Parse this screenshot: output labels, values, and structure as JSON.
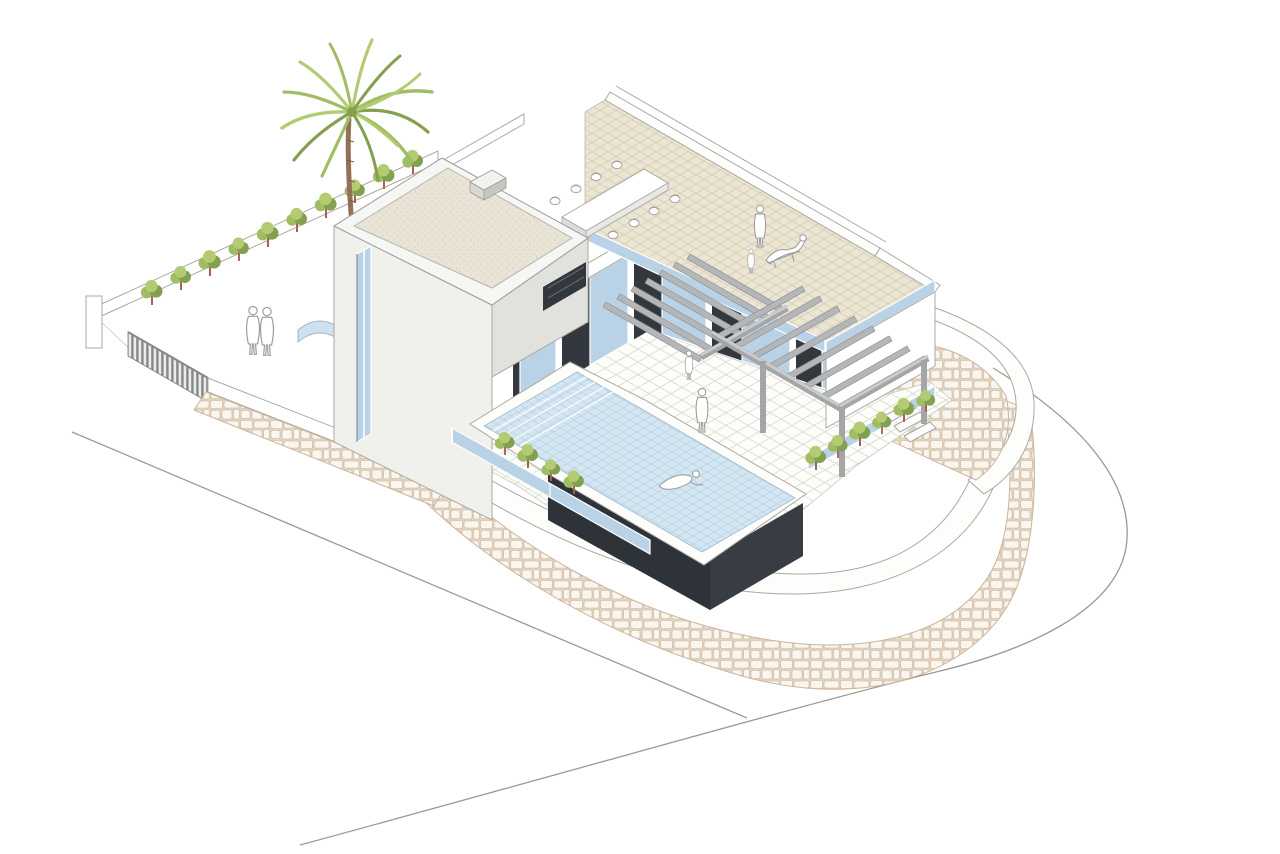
{
  "scene": {
    "type": "axonometric-architectural-illustration",
    "subject": "modern two-storey villa with infinity pool, roof terrace, pergola and landscaped plot",
    "background": "#ffffff"
  },
  "palette": {
    "bg": "#ffffff",
    "wallLight": "#f0f0ed",
    "wallShade": "#e1e1de",
    "wallOutline": "#a9a9a2",
    "roofGravel": "#e9e4d5",
    "roofTileBg": "#ebe5d3",
    "roofTileLine": "#d6cdb4",
    "groundTileLine": "#d9d9d1",
    "glassBlue": "#b9d2e6",
    "glassLight": "#cfe0ee",
    "panelDark": "#33383e",
    "pergolaSlat": "#b4b6b8",
    "pergolaEdge": "#8e9092",
    "pergolaBeam": "#a3a5a7",
    "poolWater": "#d3e6f2",
    "poolGrid": "#b7cfdf",
    "poolBaseDark": "#383d43",
    "poolBaseDarker": "#2e3339",
    "stoneBg": "#e3d4c2",
    "stoneFill": "#faf6ee",
    "stoneLine": "#cbb49c",
    "foliageLight": "#b3cc74",
    "foliageMid": "#a0bd62",
    "foliageDark": "#82a050",
    "trunkBrown": "#93705a",
    "stemBrown": "#a2654f",
    "figureFill": "#ffffff",
    "figureOutline": "#9a9a9a",
    "roadLine": "#9a9a94"
  },
  "inventory": {
    "palm_trees": 1,
    "palm_fronds": 14,
    "courtyard_hedge_shrubs": 10,
    "east_garden_shrubs": 6,
    "pool_planter_shrubs": 4,
    "dining_chairs": 8,
    "dining_tables": 1,
    "pergola_slats_west": 7,
    "pergola_slats_east": 8,
    "pergola_posts": 3,
    "figures_courtyard": 2,
    "figures_terrace": 2,
    "figures_roof_standing": 1,
    "figures_roof_child": 1,
    "figures_roof_reclining": 1,
    "figures_swimming": 1,
    "pools": 1,
    "entrance_gates": 1
  }
}
